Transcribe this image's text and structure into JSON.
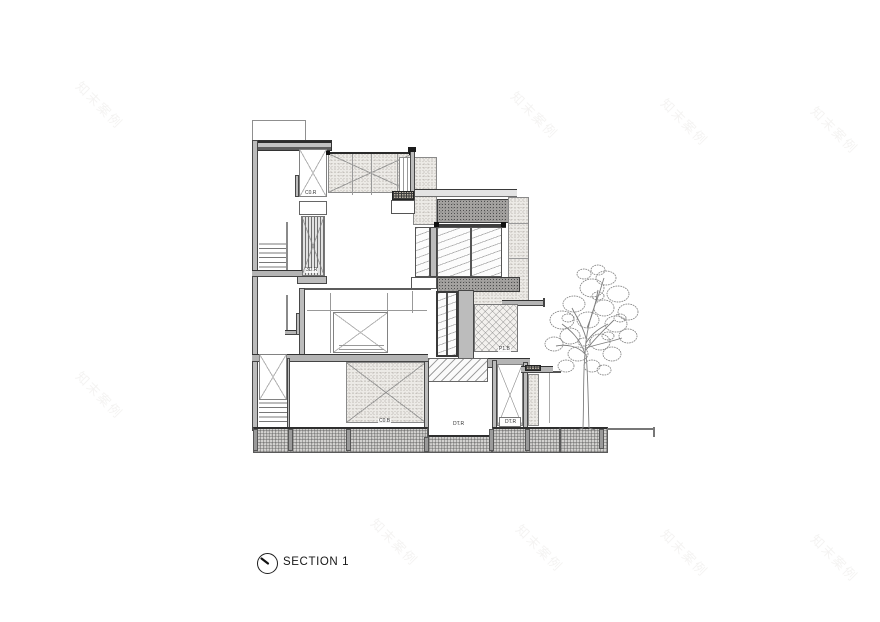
{
  "section": {
    "title": "SECTION 1"
  },
  "watermark": {
    "text": "知末案例"
  },
  "labels": {
    "core_top": "C0.R",
    "core_screen": "3D.R",
    "terrace": "P1.B",
    "basement_room": "C0.B",
    "pit_room": "DT.R",
    "light_well": "DT.R"
  },
  "colors": {
    "ink": "#4a4a4a",
    "wall_fill": "#bcbcbc",
    "stipple_light": "#eceae6",
    "stipple_dark": "#a4a2a0",
    "ground_fill": "#d2d1cf"
  }
}
